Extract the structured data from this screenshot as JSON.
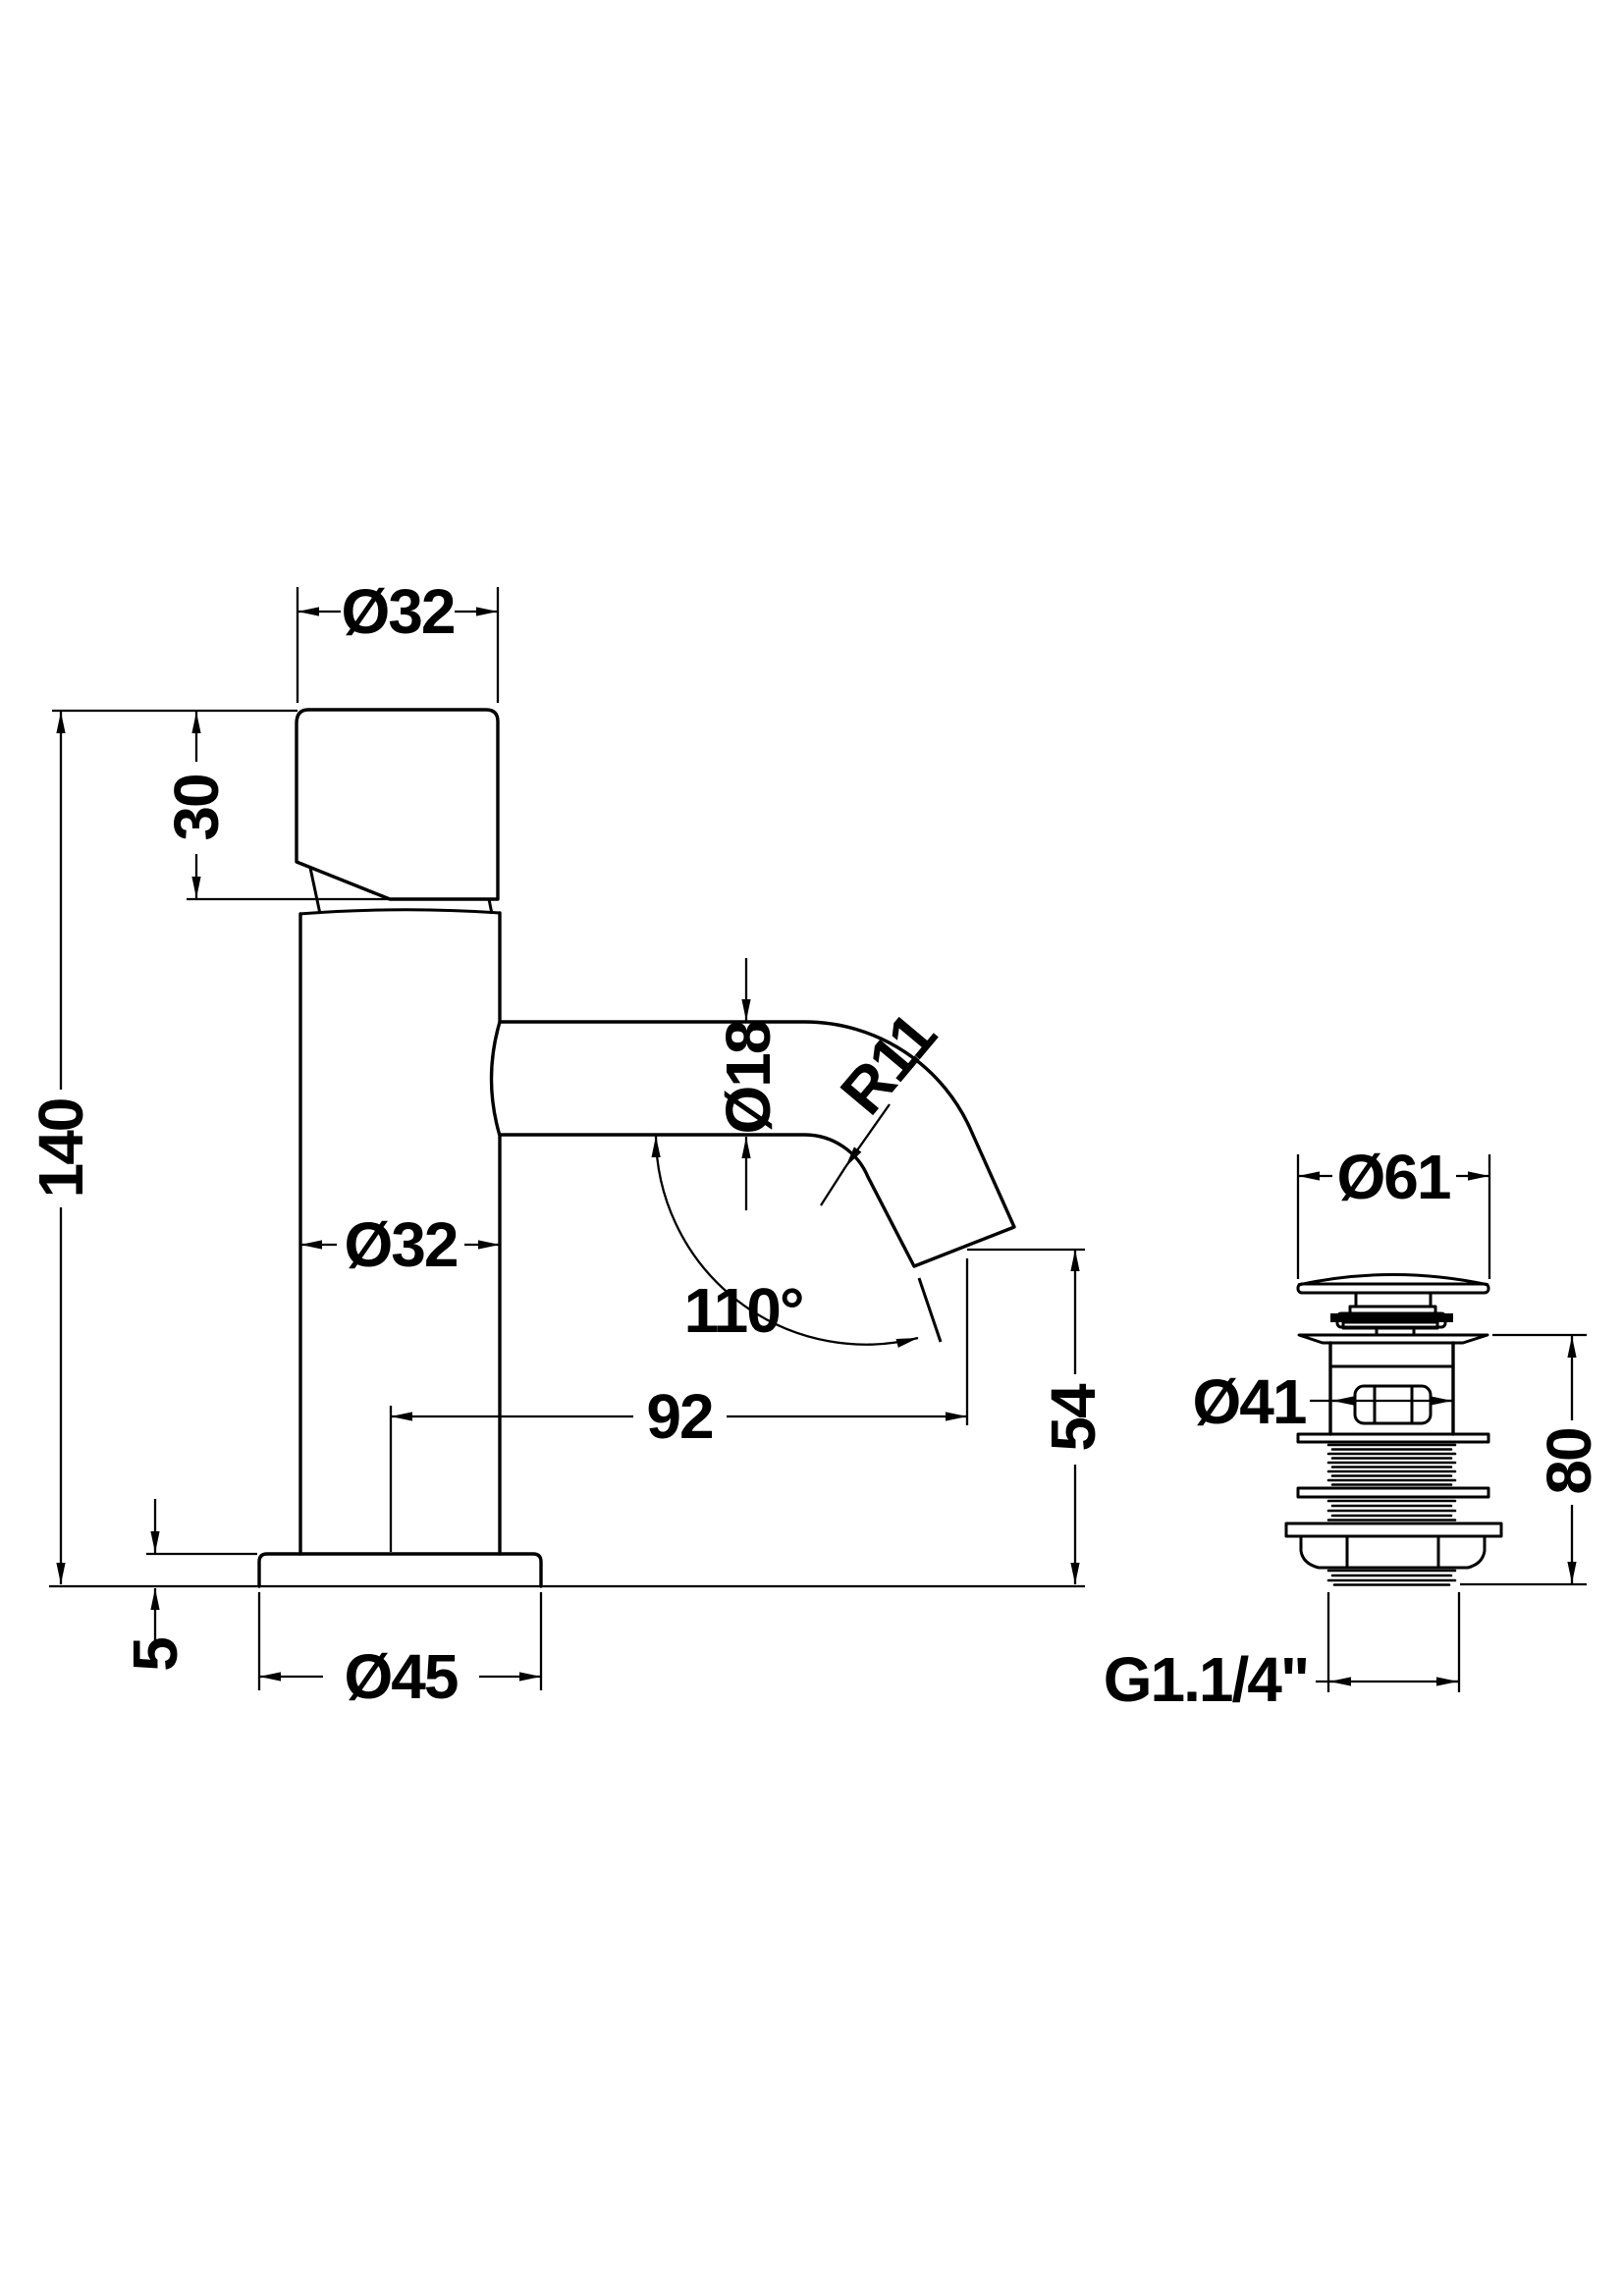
{
  "drawing": {
    "background": "#ffffff",
    "ink": "#000000",
    "type": "technical-dimension-drawing",
    "subject": "basin tap side elevation with pop-up waste fitting",
    "tap_view": {
      "dims": {
        "top_diameter": "Ø32",
        "handle_height": "30",
        "overall_height": "140",
        "body_diameter": "Ø32",
        "spout_diameter": "Ø18",
        "spout_bend_radius": "R11",
        "spout_angle": "110°",
        "spout_reach": "92",
        "spout_clearance": "54",
        "base_thickness": "5",
        "base_diameter": "Ø45"
      }
    },
    "waste_view": {
      "dims": {
        "cap_diameter": "Ø61",
        "body_diameter": "Ø41",
        "overall_height": "80",
        "thread_size": "G1.1/4\""
      }
    }
  }
}
